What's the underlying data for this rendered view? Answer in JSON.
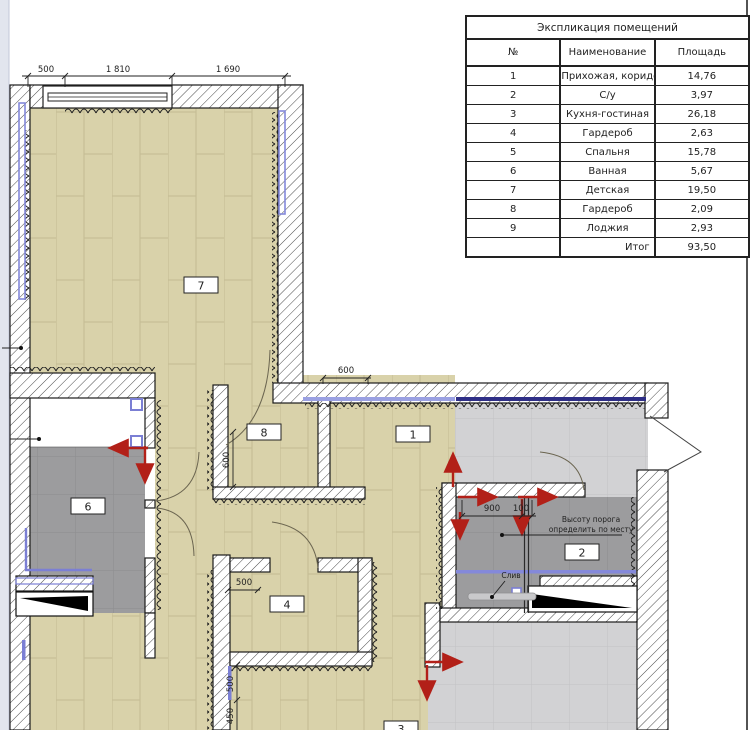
{
  "table": {
    "title": "Экспликация помещений",
    "headers": {
      "num": "№",
      "name": "Наименование",
      "area": "Площадь"
    },
    "rows": [
      {
        "n": "1",
        "name": "Прихожая, коридор",
        "area": "14,76"
      },
      {
        "n": "2",
        "name": "С/у",
        "area": "3,97"
      },
      {
        "n": "3",
        "name": "Кухня-гостиная",
        "area": "26,18"
      },
      {
        "n": "4",
        "name": "Гардероб",
        "area": "2,63"
      },
      {
        "n": "5",
        "name": "Спальня",
        "area": "15,78"
      },
      {
        "n": "6",
        "name": "Ванная",
        "area": "5,67"
      },
      {
        "n": "7",
        "name": "Детская",
        "area": "19,50"
      },
      {
        "n": "8",
        "name": "Гардероб",
        "area": "2,09"
      },
      {
        "n": "9",
        "name": "Лоджия",
        "area": "2,93"
      }
    ],
    "total_label": "Итог",
    "total_value": "93,50"
  },
  "plan": {
    "room_labels": {
      "r1": "1",
      "r2": "2",
      "r3": "3",
      "r4": "4",
      "r6": "6",
      "r7": "7",
      "r8": "8"
    },
    "dims": {
      "top_500": "500",
      "top_1810": "1 810",
      "top_1690": "1 690",
      "hall_600": "600",
      "ward8_600": "600",
      "wc_900": "900",
      "wc_100": "100",
      "ward4_500": "500",
      "low_500": "500",
      "low_450": "450"
    },
    "notes": {
      "threshold_line1": "Высоту порога",
      "threshold_line2": "определить по месту",
      "drain": "Слив"
    },
    "colors": {
      "wood_floor": "#d9d2aa",
      "tile_light": "#d2d2d4",
      "tile_dark": "#9c9c9e",
      "accent_blue": "#7b7fd4",
      "accent_navy": "#2e2e86",
      "arrow_red": "#b22018"
    }
  }
}
